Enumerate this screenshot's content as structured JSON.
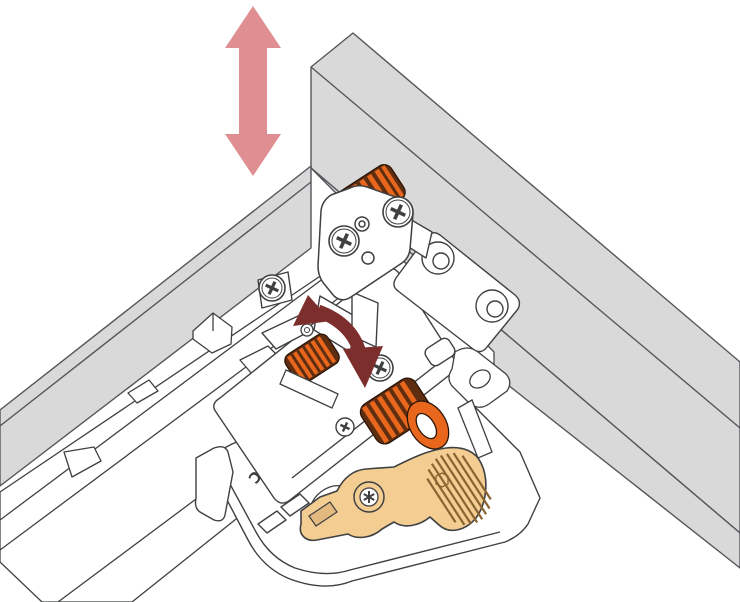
{
  "illustration": {
    "type": "technical-line-drawing",
    "subject": "Undermount drawer slide locking device at a drawer corner with height adjustment"
  },
  "labels": {
    "dtc_logo": "DTC"
  },
  "annotations": {
    "vertical_arrow": "up-down height adjustment",
    "rotation_arrow": "rotate adjustment wheel"
  },
  "icons": [
    "vertical-double-arrow-icon",
    "rotation-arrow-icon",
    "height-adjust-glyph-icon",
    "phillips-screw-icon",
    "torx-screw-icon",
    "dtc-logo"
  ],
  "colors": {
    "background": "#ffffff",
    "panel_gray": "#d9d9da",
    "panel_edge": "#55565a",
    "line": "#3f4042",
    "white": "#ffffff",
    "pink_arrow": "#df8e91",
    "rotation_arrow": "#7c2e2c",
    "wheel_orange": "#e8671d",
    "wheel_dark": "#5f2d10",
    "wheel_outline": "#2b1506",
    "lever_tan": "#f3cd92",
    "lever_slot": "#e3b97f",
    "lever_detail": "#8a6430"
  }
}
